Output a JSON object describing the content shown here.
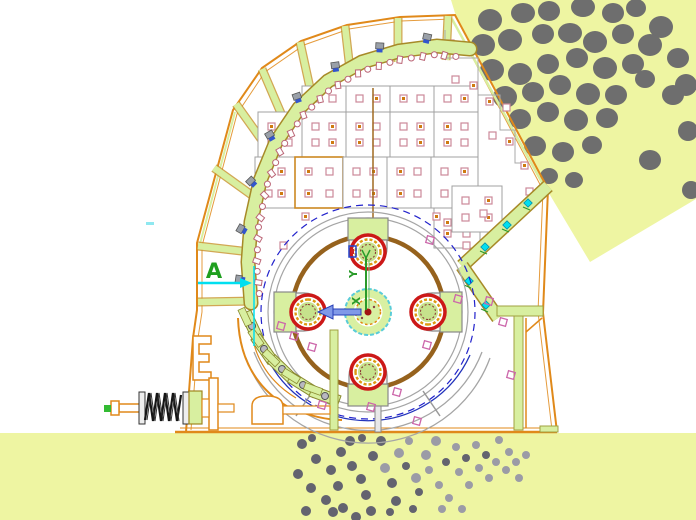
{
  "drawing": {
    "kind": "crusher-section-cad-drawing",
    "labels": {
      "section_marker": "A",
      "axis_y": "Y",
      "axis_x": "X"
    },
    "colors": {
      "ground": "#eef5a2",
      "feed_wedge": "#eef5a2",
      "rock": "#6e6e6e",
      "particle_dark": "#63636f",
      "particle_light": "#9b9ba6",
      "outline_orange": "#e0891a",
      "fill_green": "#d8efa0",
      "band_edge": "#a78a28",
      "panel_stroke": "#a0a0a0",
      "square_stroke": "#cc8899",
      "square_dot": "#cf7a10",
      "rotor_brown": "#96621d",
      "circle_gray": "#a5a5a5",
      "dash_blue": "#2222cc",
      "ring_red": "#cc1818",
      "ring_orange": "#dd9911",
      "hammer_green": "#c6e28c",
      "hub_cyan": "#59ccd8",
      "axis_green": "#2a9a2a",
      "arrow_blue": "#8099e8",
      "cyan_marker": "#00dff0",
      "magenta": "#cc66aa",
      "bolt_gray": "#9aa0a8",
      "bolt_blue": "#3355cc",
      "spring_black": "#151515",
      "scallop": "#bb6677"
    },
    "feed_rocks": [
      [
        490,
        20,
        12,
        11
      ],
      [
        523,
        13,
        12,
        10
      ],
      [
        549,
        11,
        11,
        10
      ],
      [
        583,
        7,
        12,
        10
      ],
      [
        613,
        13,
        11,
        10
      ],
      [
        636,
        8,
        10,
        9
      ],
      [
        661,
        27,
        12,
        11
      ],
      [
        483,
        45,
        12,
        11
      ],
      [
        510,
        40,
        12,
        11
      ],
      [
        543,
        34,
        11,
        10
      ],
      [
        570,
        33,
        12,
        10
      ],
      [
        595,
        42,
        12,
        11
      ],
      [
        623,
        34,
        11,
        10
      ],
      [
        650,
        45,
        12,
        11
      ],
      [
        678,
        58,
        11,
        10
      ],
      [
        492,
        70,
        12,
        11
      ],
      [
        520,
        74,
        12,
        11
      ],
      [
        548,
        64,
        11,
        10
      ],
      [
        577,
        58,
        11,
        10
      ],
      [
        605,
        68,
        12,
        11
      ],
      [
        633,
        64,
        11,
        10
      ],
      [
        686,
        85,
        11,
        11
      ],
      [
        505,
        97,
        12,
        11
      ],
      [
        533,
        92,
        11,
        10
      ],
      [
        560,
        85,
        11,
        10
      ],
      [
        588,
        94,
        12,
        11
      ],
      [
        616,
        95,
        11,
        10
      ],
      [
        645,
        79,
        10,
        9
      ],
      [
        673,
        95,
        11,
        10
      ],
      [
        520,
        119,
        11,
        10
      ],
      [
        548,
        112,
        11,
        10
      ],
      [
        576,
        120,
        12,
        11
      ],
      [
        607,
        118,
        11,
        10
      ],
      [
        688,
        131,
        10,
        10
      ],
      [
        535,
        146,
        11,
        10
      ],
      [
        563,
        152,
        11,
        10
      ],
      [
        592,
        145,
        10,
        9
      ],
      [
        650,
        160,
        11,
        10
      ],
      [
        549,
        176,
        9,
        8
      ],
      [
        574,
        180,
        9,
        8
      ],
      [
        691,
        190,
        9,
        9
      ]
    ],
    "particles": [
      [
        302,
        444,
        5,
        0
      ],
      [
        316,
        459,
        5,
        0
      ],
      [
        298,
        474,
        5,
        0
      ],
      [
        311,
        488,
        5,
        0
      ],
      [
        326,
        500,
        5,
        0
      ],
      [
        306,
        511,
        5,
        0
      ],
      [
        331,
        470,
        5,
        0
      ],
      [
        341,
        452,
        5,
        0
      ],
      [
        338,
        486,
        5,
        0
      ],
      [
        352,
        466,
        5,
        0
      ],
      [
        350,
        441,
        5,
        0
      ],
      [
        361,
        479,
        5,
        0
      ],
      [
        366,
        495,
        5,
        0
      ],
      [
        371,
        511,
        5,
        0
      ],
      [
        373,
        456,
        5,
        0
      ],
      [
        385,
        468,
        5,
        1
      ],
      [
        381,
        441,
        5,
        0
      ],
      [
        392,
        483,
        5,
        0
      ],
      [
        396,
        501,
        5,
        0
      ],
      [
        399,
        453,
        5,
        1
      ],
      [
        406,
        466,
        4,
        0
      ],
      [
        409,
        441,
        4,
        1
      ],
      [
        416,
        478,
        5,
        1
      ],
      [
        419,
        492,
        4,
        0
      ],
      [
        426,
        455,
        5,
        1
      ],
      [
        429,
        470,
        4,
        1
      ],
      [
        436,
        441,
        5,
        1
      ],
      [
        439,
        485,
        4,
        1
      ],
      [
        446,
        462,
        4,
        0
      ],
      [
        449,
        498,
        4,
        1
      ],
      [
        456,
        447,
        4,
        1
      ],
      [
        459,
        472,
        4,
        1
      ],
      [
        466,
        458,
        4,
        0
      ],
      [
        469,
        485,
        4,
        1
      ],
      [
        476,
        445,
        4,
        1
      ],
      [
        479,
        468,
        4,
        1
      ],
      [
        486,
        455,
        4,
        0
      ],
      [
        489,
        478,
        4,
        1
      ],
      [
        496,
        462,
        4,
        1
      ],
      [
        499,
        440,
        4,
        1
      ],
      [
        506,
        470,
        4,
        1
      ],
      [
        509,
        452,
        4,
        1
      ],
      [
        516,
        462,
        4,
        1
      ],
      [
        519,
        478,
        4,
        1
      ],
      [
        526,
        455,
        4,
        1
      ],
      [
        343,
        508,
        5,
        0
      ],
      [
        356,
        517,
        5,
        0
      ],
      [
        312,
        438,
        4,
        0
      ],
      [
        362,
        438,
        4,
        0
      ],
      [
        413,
        509,
        4,
        0
      ],
      [
        390,
        512,
        4,
        0
      ],
      [
        333,
        512,
        5,
        0
      ],
      [
        442,
        509,
        4,
        1
      ],
      [
        462,
        509,
        4,
        1
      ]
    ],
    "liner_panels": [
      [
        302,
        86,
        44,
        26,
        0
      ],
      [
        346,
        86,
        44,
        26,
        0
      ],
      [
        390,
        86,
        44,
        26,
        0
      ],
      [
        434,
        86,
        44,
        26,
        0
      ],
      [
        258,
        112,
        44,
        45,
        0
      ],
      [
        302,
        112,
        44,
        45,
        0
      ],
      [
        346,
        112,
        44,
        45,
        0
      ],
      [
        390,
        112,
        44,
        45,
        0
      ],
      [
        434,
        112,
        44,
        45,
        0
      ],
      [
        255,
        157,
        40,
        51,
        0
      ],
      [
        295,
        157,
        48,
        51,
        1
      ],
      [
        343,
        157,
        44,
        51,
        0
      ],
      [
        387,
        157,
        44,
        51,
        0
      ],
      [
        431,
        157,
        47,
        51,
        0
      ],
      [
        434,
        208,
        46,
        40,
        0
      ],
      [
        452,
        186,
        50,
        46,
        0
      ]
    ],
    "extra_squares": [
      [
        447,
        40,
        1
      ],
      [
        465,
        46,
        0
      ],
      [
        452,
        76,
        0
      ],
      [
        470,
        82,
        1
      ],
      [
        486,
        98,
        1
      ],
      [
        503,
        104,
        0
      ],
      [
        489,
        132,
        0
      ],
      [
        506,
        138,
        1
      ],
      [
        521,
        162,
        1
      ],
      [
        526,
        188,
        0
      ],
      [
        280,
        242,
        0
      ],
      [
        302,
        213,
        1
      ],
      [
        433,
        213,
        1
      ],
      [
        463,
        242,
        0
      ],
      [
        480,
        210,
        0
      ]
    ],
    "magenta_markers": [
      [
        294,
        336
      ],
      [
        312,
        347
      ],
      [
        281,
        326
      ],
      [
        427,
        345
      ],
      [
        458,
        299
      ],
      [
        489,
        301
      ],
      [
        511,
        375
      ],
      [
        430,
        240
      ],
      [
        322,
        405
      ],
      [
        371,
        407
      ],
      [
        397,
        392
      ],
      [
        417,
        421
      ],
      [
        503,
        322
      ]
    ],
    "cyan_bolts": [
      [
        528,
        203
      ],
      [
        507,
        225
      ],
      [
        485,
        247
      ],
      [
        469,
        281
      ],
      [
        486,
        305
      ]
    ],
    "cradle_plates_outer": [
      [
        252,
        326,
        65
      ],
      [
        264,
        349,
        55
      ],
      [
        282,
        369,
        44
      ],
      [
        303,
        385,
        32
      ],
      [
        325,
        396,
        20
      ]
    ],
    "cradle_plates_inner": [
      [
        245,
        317,
        65
      ],
      [
        256,
        338,
        55
      ],
      [
        271,
        358,
        44
      ],
      [
        291,
        376,
        32
      ],
      [
        313,
        389,
        20
      ]
    ],
    "breaker_band": {
      "points": [
        [
          251,
          303
        ],
        [
          248,
          262
        ],
        [
          251,
          222
        ],
        [
          260,
          181
        ],
        [
          276,
          142
        ],
        [
          299,
          108
        ],
        [
          328,
          81
        ],
        [
          362,
          62
        ],
        [
          399,
          51
        ],
        [
          437,
          46
        ],
        [
          470,
          49
        ]
      ],
      "chamber_center": [
        368,
        300
      ],
      "scallop_spacing": 11,
      "bolt_every": 4
    },
    "rotor": {
      "center": [
        368,
        312
      ],
      "hammer_angles": [
        0,
        90,
        180,
        270
      ]
    }
  }
}
